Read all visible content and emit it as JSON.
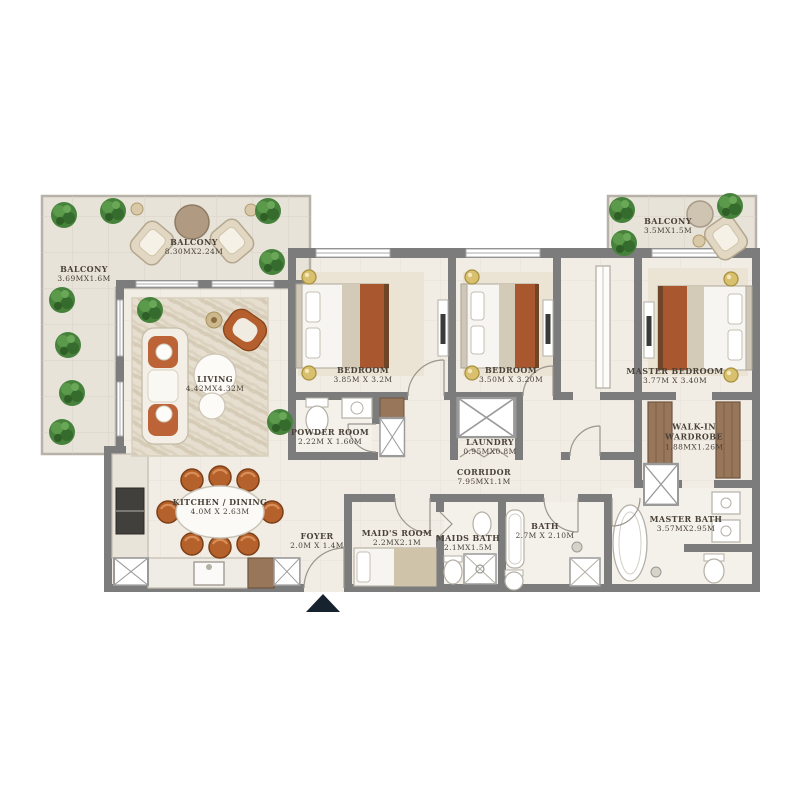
{
  "rooms": {
    "balcony_top": {
      "name": "BALCONY",
      "dims": "8.30MX2.24M"
    },
    "balcony_left": {
      "name": "BALCONY",
      "dims": "3.69MX1.6M"
    },
    "balcony_right": {
      "name": "BALCONY",
      "dims": "3.5MX1.5M"
    },
    "living": {
      "name": "LIVING",
      "dims": "4.42MX4.32M"
    },
    "bedroom1": {
      "name": "BEDROOM",
      "dims": "3.85M X 3.2M"
    },
    "bedroom2": {
      "name": "BEDROOM",
      "dims": "3.50M X 3.20M"
    },
    "master_bedroom": {
      "name": "MASTER BEDROOM",
      "dims": "3.77M X 3.40M"
    },
    "powder_room": {
      "name": "POWDER ROOM",
      "dims": "2.22M X 1.66M"
    },
    "laundry": {
      "name": "LAUNDRY",
      "dims": "0.95MX0.8M"
    },
    "walk_in_wardrobe": {
      "name": "WALK-IN WARDROBE",
      "dims": "1.88MX1.26M"
    },
    "corridor": {
      "name": "CORRIDOR",
      "dims": "7.95MX1.1M"
    },
    "kitchen_dining": {
      "name": "KITCHEN / DINING",
      "dims": "4.0M X 2.63M"
    },
    "foyer": {
      "name": "FOYER",
      "dims": "2.0M X 1.4M"
    },
    "maids_room": {
      "name": "MAID'S ROOM",
      "dims": "2.2MX2.1M"
    },
    "maids_bath": {
      "name": "MAIDS BATH",
      "dims": "2.1MX1.5M"
    },
    "bath": {
      "name": "BATH",
      "dims": "2.7M X 2.10M"
    },
    "master_bath": {
      "name": "MASTER BATH",
      "dims": "3.57MX2.95M"
    }
  },
  "colors": {
    "wall": "#7c7c7c",
    "floor": "#f1ece4",
    "balcony_floor": "#e8e3d9",
    "accent_rust": "#ad5a31",
    "wood": "#97765a",
    "plant_green": "#47823c",
    "label_text": "#4a4238",
    "entrance_marker": "#16222e"
  }
}
